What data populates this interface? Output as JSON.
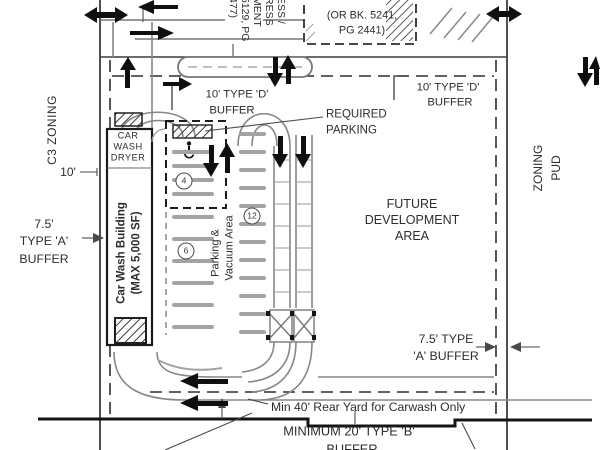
{
  "labels": {
    "c3_zoning": "C3 ZONING",
    "zoning_pud": [
      "ZONING",
      "PUD"
    ],
    "dim_10": "10'",
    "buffer_a_left": [
      "7.5'",
      "TYPE 'A'",
      "BUFFER"
    ],
    "buffer_d_left": [
      "10' TYPE 'D'",
      "BUFFER"
    ],
    "buffer_d_right": [
      "10' TYPE 'D'",
      "BUFFER"
    ],
    "buffer_a_right": [
      "7.5' TYPE",
      "'A' BUFFER"
    ],
    "buffer_b_bottom": [
      "MINIMUM 20' TYPE 'B'",
      "BUFFER"
    ],
    "required_parking": [
      "REQUIRED",
      "PARKING"
    ],
    "future_development": [
      "FUTURE",
      "DEVELOPMENT",
      "AREA"
    ],
    "rear_yard": "Min 40' Rear Yard for Carwash Only",
    "car_wash_dryer": [
      "CAR",
      "WASH",
      "DRYER"
    ],
    "building": [
      "Car Wash Building",
      "(MAX 5,000 SF)"
    ],
    "parking_vacuum": [
      "Parking &",
      "Vacuum Area"
    ]
  },
  "easements": {
    "note_partial_top": "ACCESS ESMT.",
    "note": [
      "(OR BK. 5241,",
      "PG 2441)"
    ],
    "vertical_fragments": [
      "ESS /",
      "RESS",
      "MENT",
      "5129, PG",
      "477)"
    ]
  },
  "parking_counts": {
    "accessible_row": "4",
    "front_row": "6",
    "vacuum_row": "12"
  },
  "colors": {
    "line": "#3c3c3c",
    "road": "#878787",
    "stall": "#a3a3a3",
    "arrow": "#0f0f0f",
    "text": "#2d2d2d",
    "background": "#ffffff"
  }
}
